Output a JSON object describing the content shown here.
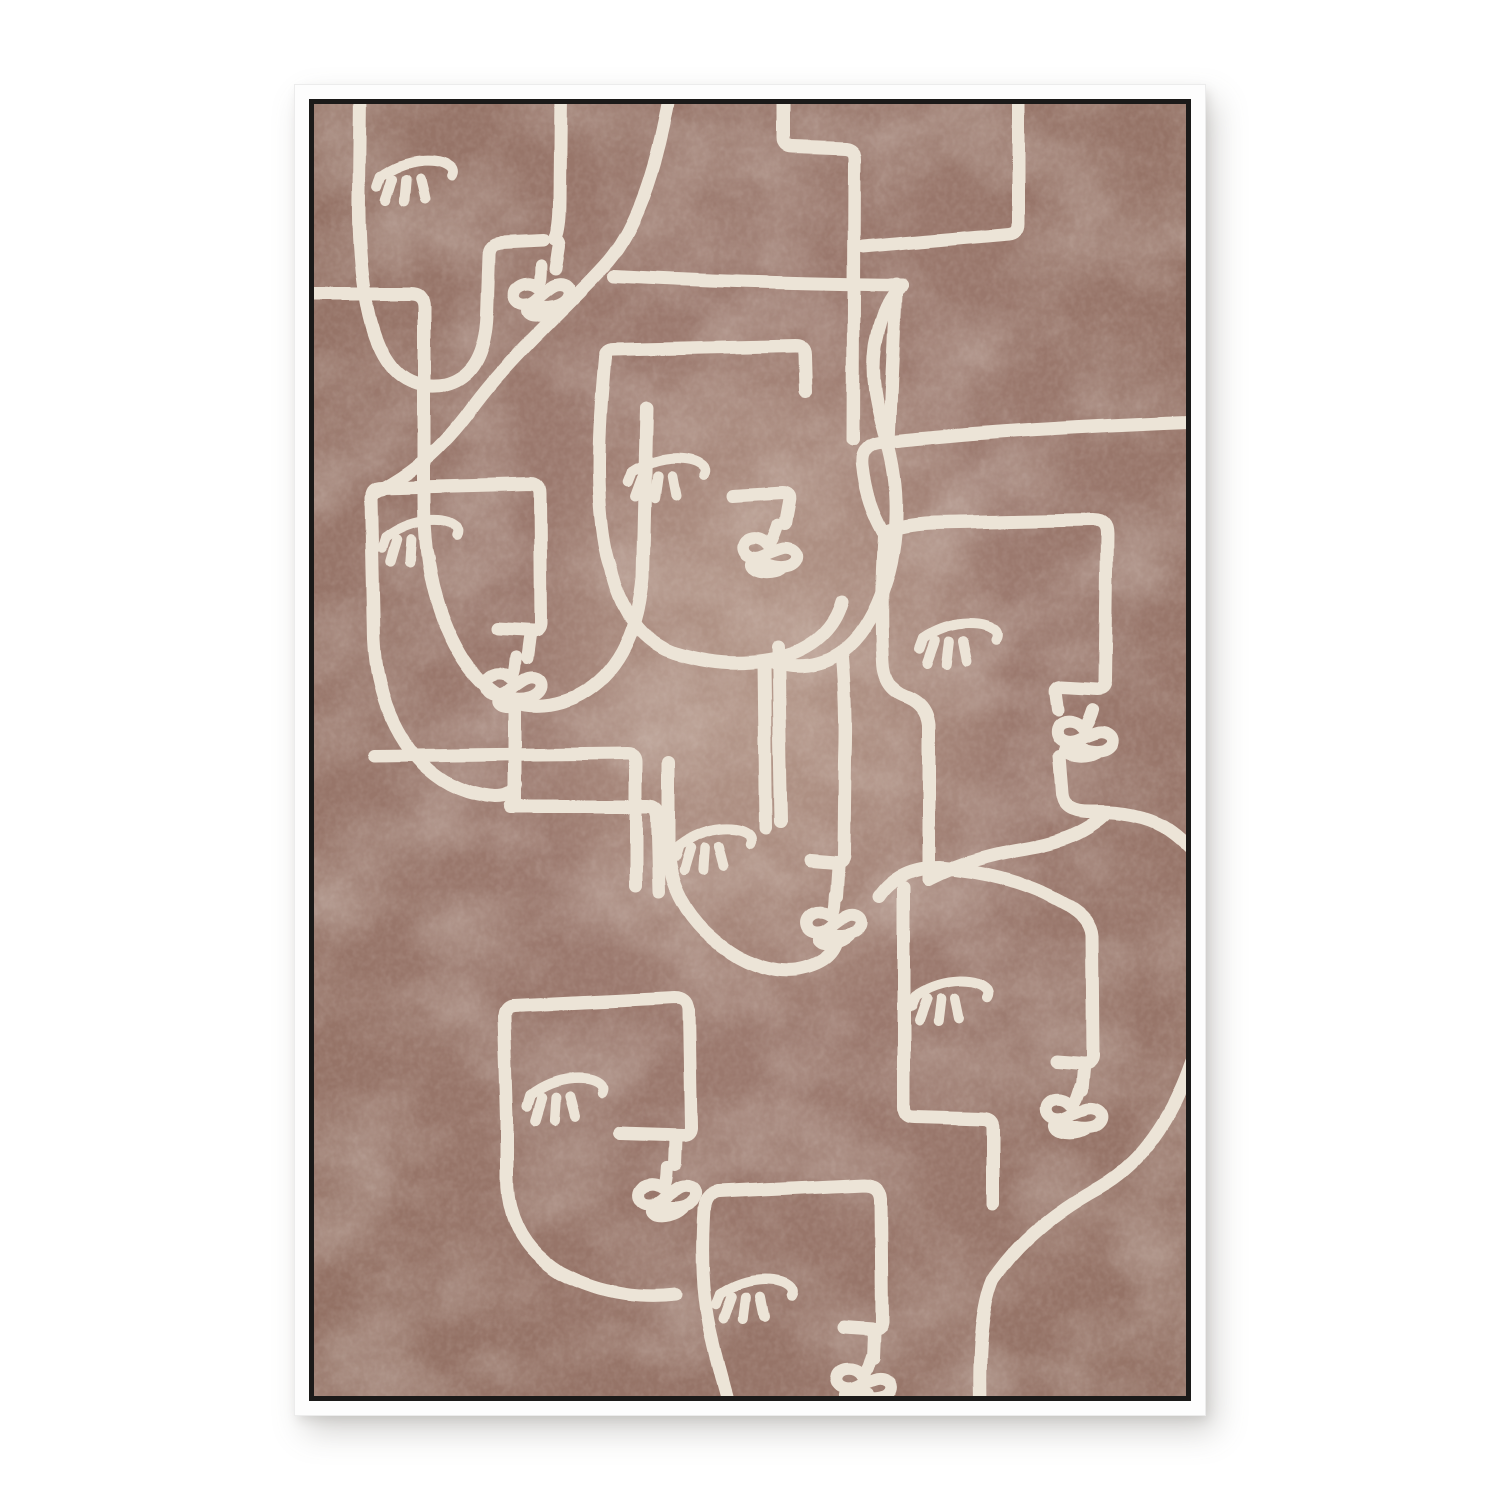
{
  "artwork": {
    "kind": "framed-art-print",
    "subject": "continuous one-line drawing of eight overlapping abstract faces with closed eyes, stepped profile noses and scribbled loop mouths",
    "face_count": 8,
    "colors": {
      "page_background": "#ffffff",
      "frame_white": "#fdfdfd",
      "frame_border_black": "#1b1a19",
      "canvas_brown_base": "#9b796e",
      "canvas_brown_dark": "#927063",
      "canvas_brown_light": "#c4ab9c",
      "line_cream": "#ece4d7"
    },
    "frame": {
      "left": 295,
      "top": 85,
      "width": 910,
      "height": 1330,
      "white_band_px": 14,
      "black_line_px": 5
    },
    "canvas_viewbox": "0 0 872 1292",
    "line_style": {
      "stroke_width": 13,
      "eye_stroke_width": 10,
      "mouth_stroke_width": 12
    },
    "motifs": {
      "eye": {
        "arc": "M -36 2 Q -14 -10 10 -8 Q 30 -6 36 3 Q 38 7 35 11",
        "tick": "M -36 2 L -41 12",
        "lashes": [
          "M -25 6 L -35 27",
          "M -11 8 L -16 30",
          "M 3 9 L 5 29"
        ]
      },
      "mouth": "M 3 -26 C 1 -16 0 -10 -4 -6 C -13 -15 -29 -11 -29 -1 C -29 9 -16 12 -7 6 C 0 1 3 0 9 -3 C 19 -8 30 -2 26 7 C 22 15 9 17 -3 14 C -17 11 -22 15 -16 20 C -10 24 4 23 12 17"
    },
    "faces": [
      {
        "name": "face-top-left",
        "eye": [
          102,
          66,
          -8
        ],
        "mouth": [
          229,
          188,
          -10
        ],
        "paths": [
          "M -12 190 L 96 190 Q 110 190 110 204 L 110 396 Q 110 494 150 556 Q 194 622 260 594 Q 320 566 329 474 L 333 305",
          "M 46 -12 L 45 90 Q 44 178 60 228 Q 80 290 132 281 Q 170 272 173 212 L 175 152 Q 175 140 187 139 L 230 137",
          "M 247 -12 L 246 96 Q 246 124 241 136 Q 247 137 245 146 L 242 165"
        ]
      },
      {
        "name": "face-top-center-head",
        "eye": null,
        "mouth": null,
        "paths": [
          "M 470 -12 L 470 34 Q 470 43 479 43 L 531 45 Q 540 46 540 55 L 539 336",
          "M 704 -12 L 704 120 Q 704 129 695 130 L 549 143",
          "M 582 180 L 575 338",
          "M 300 172 C 390 177 500 180 588 181",
          "M 356 -12 C 342 70 320 130 290 162 C 248 208 196 252 158 304 C 128 345 96 372 58 390"
        ]
      },
      {
        "name": "face-center",
        "eye": [
          354,
          363,
          -5
        ],
        "mouth": [
          457,
          447,
          8
        ],
        "paths": [
          "M 291 254 Q 291 246 300 246 L 482 242 Q 491 242 491 251 L 492 288",
          "M 291 254 Q 285 320 285 360 Q 285 430 297 463 Q 312 532 362 549 Q 424 568 478 550 Q 518 534 528 498",
          "M 588 181 Q 568 200 561 242 C 553 302 580 332 582 396 C 584 462 562 522 528 548 Q 498 570 458 558",
          "M 420 392 L 468 389 Q 477 389 475 398 L 471 420",
          "M 450 558 L 452 724",
          "M 464 544 L 467 718"
        ]
      },
      {
        "name": "face-mid-left",
        "eye": [
          107,
          426,
          -9
        ],
        "mouth": [
          201,
          580,
          -6
        ],
        "paths": [
          "M 58 392 Q 58 384 67 384 L 216 380 Q 226 380 226 390 L 227 519",
          "M 57 394 Q 59 480 60 535 Q 63 602 96 646 Q 131 690 181 693 Q 200 693 202 681",
          "M 227 519 Q 227 527 219 527 L 184 525",
          "M 216 531 L 213 554",
          "M 201 601 L 201 700",
          "M 60 652 L 314 649 Q 322 649 322 657 L 322 782",
          "M 196 703 L 334 703 Q 343 703 343 712 L 345 788"
        ]
      },
      {
        "name": "face-right",
        "eye": [
          645,
          529,
          -6
        ],
        "mouth": [
          772,
          631,
          8
        ],
        "paths": [
          "M 876 318 C 770 322 660 328 566 339 Q 546 342 548 362 C 551 390 559 410 569 428",
          "M 569 428 Q 590 420 620 419 L 779 416 Q 793 416 793 430 L 791 577",
          "M 570 432 Q 566 500 569 558 Q 570 584 591 592 Q 613 600 615 621 L 615 775",
          "M 791 577 Q 791 585 783 585 L 748 583 Q 740 583 742 591 L 744 606",
          "M 746 652 L 749 691 Q 750 709 779 708 Q 821 707 849 722 Q 864 731 880 748",
          "M 615 775 Q 658 753 716 744 Q 763 736 791 711"
        ]
      },
      {
        "name": "face-center-bottom",
        "eye": [
          400,
          734,
          -9
        ],
        "mouth": [
          521,
          817,
          -8
        ],
        "paths": [
          "M 354 658 L 354 742 Q 354 790 391 827 Q 436 870 482 866 Q 517 860 523 838",
          "M 528 548 Q 533 600 531 657 L 530 751 Q 530 759 522 759 L 497 757",
          "M 524 763 L 522 792"
        ]
      },
      {
        "name": "face-bottom-right",
        "eye": [
          637,
          886,
          -6
        ],
        "mouth": [
          761,
          1008,
          6
        ],
        "paths": [
          "M 566 792 Q 585 764 626 764 Q 700 770 753 801 Q 777 815 778 832 L 779 951",
          "M 779 951 Q 779 959 770 959 L 742 957",
          "M 770 964 L 768 986",
          "M 590 784 L 590 1003 Q 590 1013 600 1013 L 669 1015 Q 679 1015 679 1025 L 679 1100",
          "M 878 958 Q 847 1048 785 1084 Q 715 1122 679 1176 Q 664 1212 666 1296"
        ]
      },
      {
        "name": "face-bottom-left",
        "eye": [
          252,
          984,
          -9
        ],
        "mouth": [
          354,
          1089,
          -8
        ],
        "paths": [
          "M 199 902 L 361 894 Q 374 894 375 906 L 377 1023",
          "M 199 902 Q 190 903 190 913 L 193 1016",
          "M 377 1023 Q 377 1031 369 1031 L 306 1029",
          "M 362 1035 L 361 1060",
          "M 193 1016 L 193 1074 Q 193 1136 246 1169 Q 301 1198 362 1191"
        ]
      },
      {
        "name": "face-bottom-center",
        "eye": [
          442,
          1184,
          -6
        ],
        "mouth": [
          551,
          1278,
          6
        ],
        "paths": [
          "M 404 1088 L 551 1081 Q 566 1081 567 1095 L 568 1217",
          "M 404 1088 Q 392 1090 390 1105 Q 385 1182 398 1233 Q 405 1264 414 1296",
          "M 568 1217 Q 568 1225 560 1225 L 531 1223",
          "M 560 1229 L 559 1254",
          "M 554 1290 L 556 1296"
        ]
      }
    ]
  }
}
